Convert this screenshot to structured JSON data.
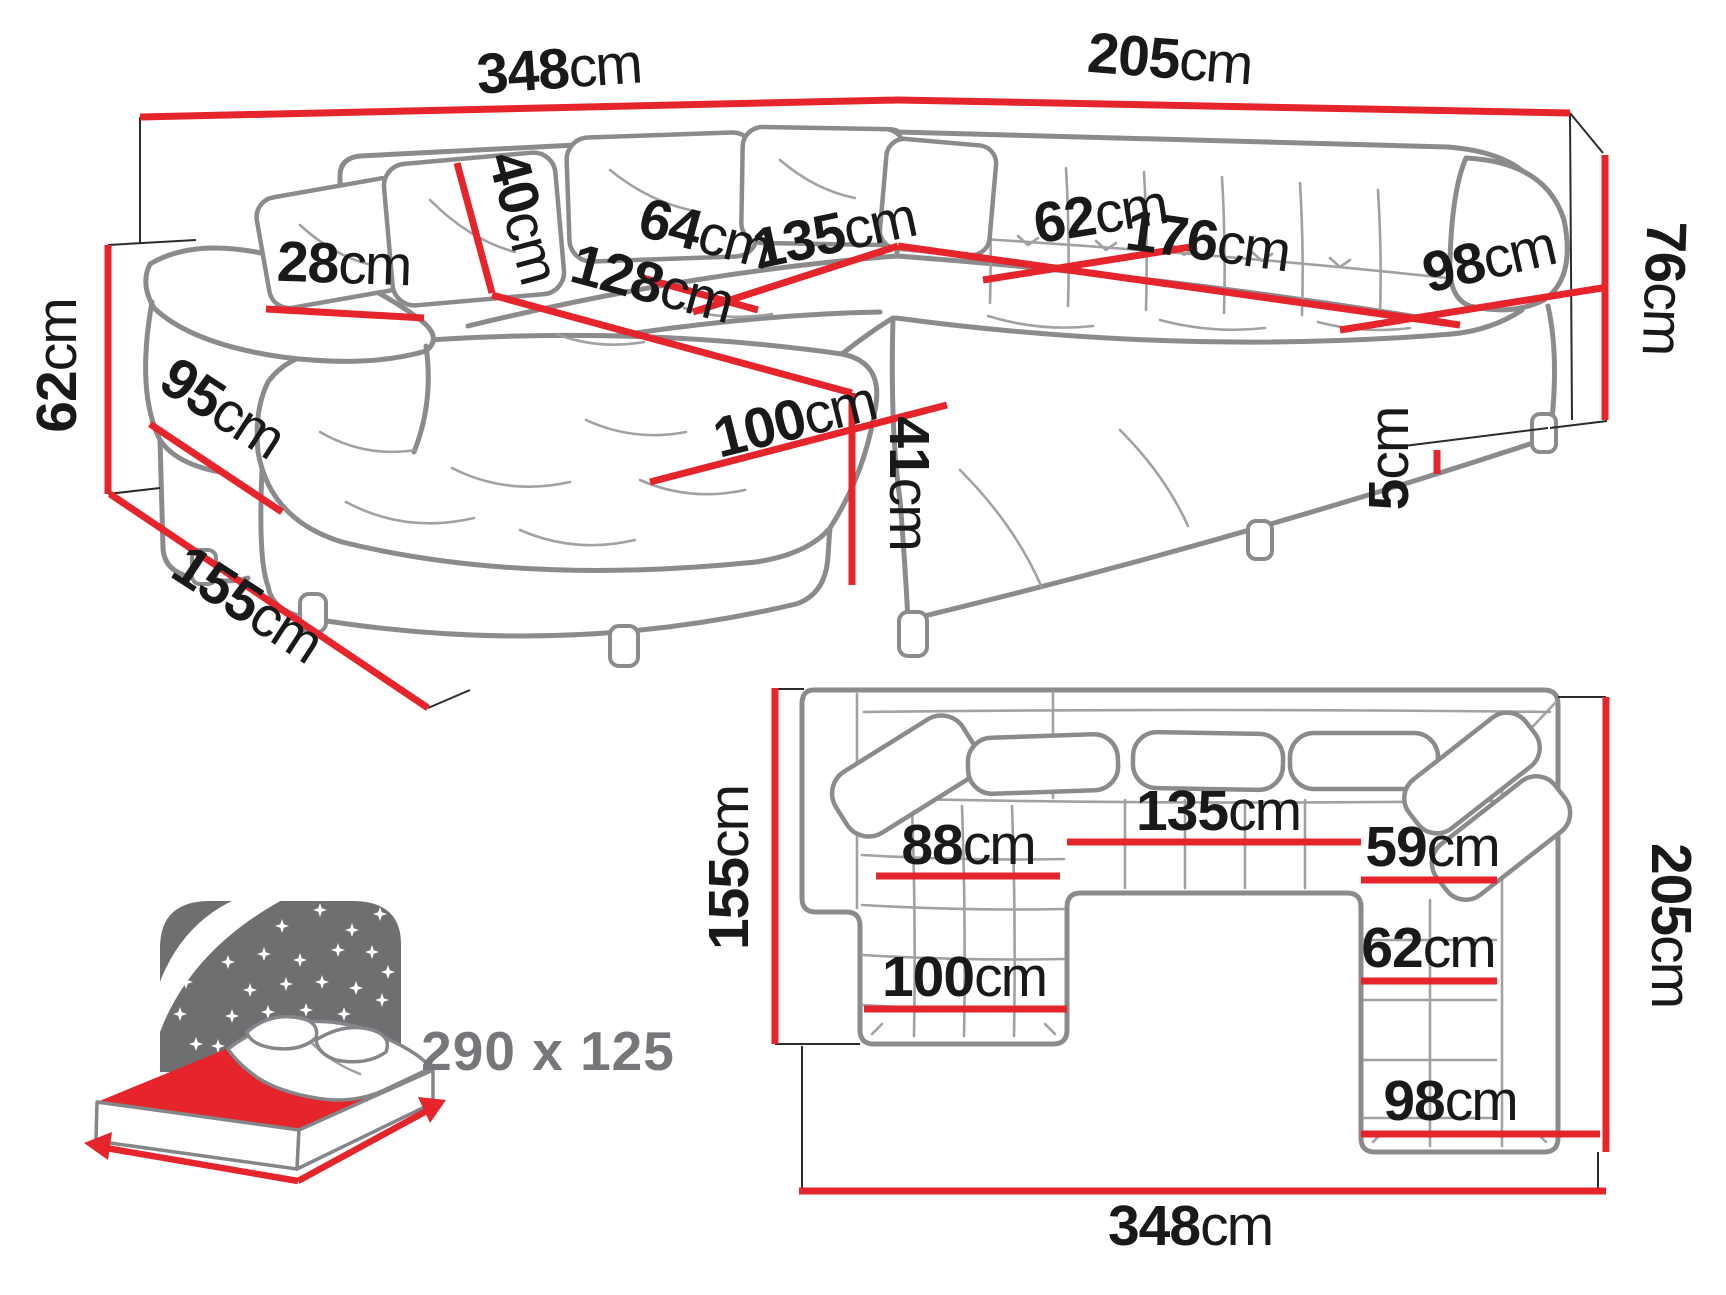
{
  "colors": {
    "dimension_line": "#e5242b",
    "label_text": "#19191a",
    "sofa_outline": "#8b8b8d",
    "icon_gray": "#6e6f71",
    "icon_text": "#76777a"
  },
  "perspective_view": {
    "dimensions": {
      "back_width": {
        "value": "348",
        "unit": "cm"
      },
      "right_side_length": {
        "value": "205",
        "unit": "cm"
      },
      "backrest_height": {
        "value": "76",
        "unit": "cm"
      },
      "cushion_height": {
        "value": "40",
        "unit": "cm"
      },
      "armrest_width": {
        "value": "28",
        "unit": "cm"
      },
      "arm_side_height": {
        "value": "62",
        "unit": "cm"
      },
      "arm_side_depth": {
        "value": "95",
        "unit": "cm"
      },
      "chaise_side_depth": {
        "value": "155",
        "unit": "cm"
      },
      "seat_depth": {
        "value": "64",
        "unit": "cm"
      },
      "middle_seat_width": {
        "value": "135",
        "unit": "cm"
      },
      "chaise_length": {
        "value": "128",
        "unit": "cm"
      },
      "chaise_width": {
        "value": "100",
        "unit": "cm"
      },
      "seat_height": {
        "value": "41",
        "unit": "cm"
      },
      "corner_seat_width": {
        "value": "62",
        "unit": "cm"
      },
      "right_seat_width": {
        "value": "176",
        "unit": "cm"
      },
      "right_end_width": {
        "value": "98",
        "unit": "cm"
      },
      "leg_height": {
        "value": "5",
        "unit": "cm"
      }
    }
  },
  "plan_view": {
    "dimensions": {
      "chaise_depth": {
        "value": "155",
        "unit": "cm"
      },
      "right_depth": {
        "value": "205",
        "unit": "cm"
      },
      "total_width": {
        "value": "348",
        "unit": "cm"
      },
      "chaise_inner_width": {
        "value": "88",
        "unit": "cm"
      },
      "middle_width": {
        "value": "135",
        "unit": "cm"
      },
      "right_inner_upper": {
        "value": "59",
        "unit": "cm"
      },
      "right_inner_lower": {
        "value": "62",
        "unit": "cm"
      },
      "right_end_width": {
        "value": "98",
        "unit": "cm"
      },
      "chaise_width": {
        "value": "100",
        "unit": "cm"
      }
    }
  },
  "sleeping_function": {
    "size_label": "290 x 125"
  }
}
